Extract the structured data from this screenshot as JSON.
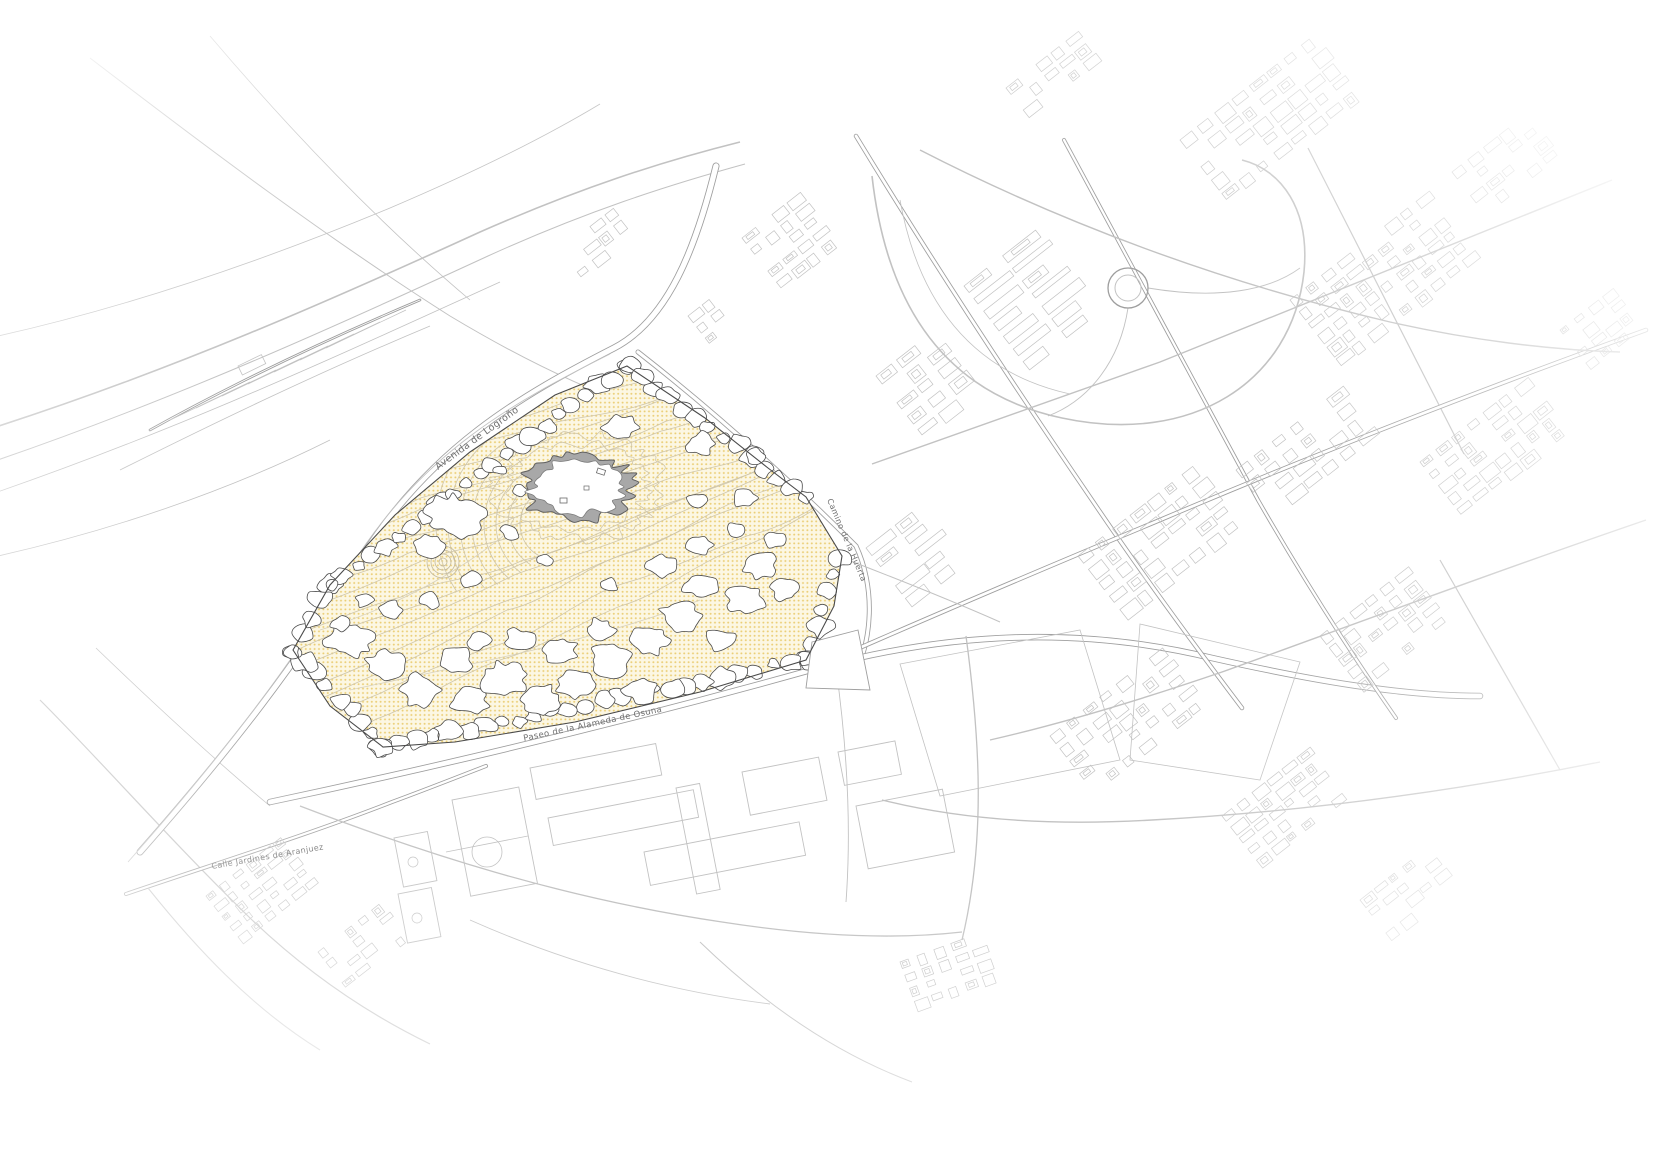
{
  "map": {
    "street_labels": {
      "avenida_logrono": "Avenida de Logroño",
      "camino_huerta": "Camino de la Huerta",
      "paseo_alameda_osuna": "Paseo de la Alameda de Osuna",
      "calle_jardines_aranjuez": "Calle Jardines de Aranjuez"
    },
    "colors": {
      "background": "#ffffff",
      "line_light": "#c2c2c2",
      "line_mid": "#9e9e9e",
      "line_dark": "#4a4a4a",
      "park_fill": "#fcf7e3",
      "park_dot": "#e8c763",
      "contour": "#cfc6ab",
      "canopy_fill": "#ffffff",
      "canopy_stroke": "#4a4a4a",
      "pond_band": "#a8a8a8",
      "pond_edge": "#5f5f5f",
      "label": "#6f6f6f"
    }
  }
}
